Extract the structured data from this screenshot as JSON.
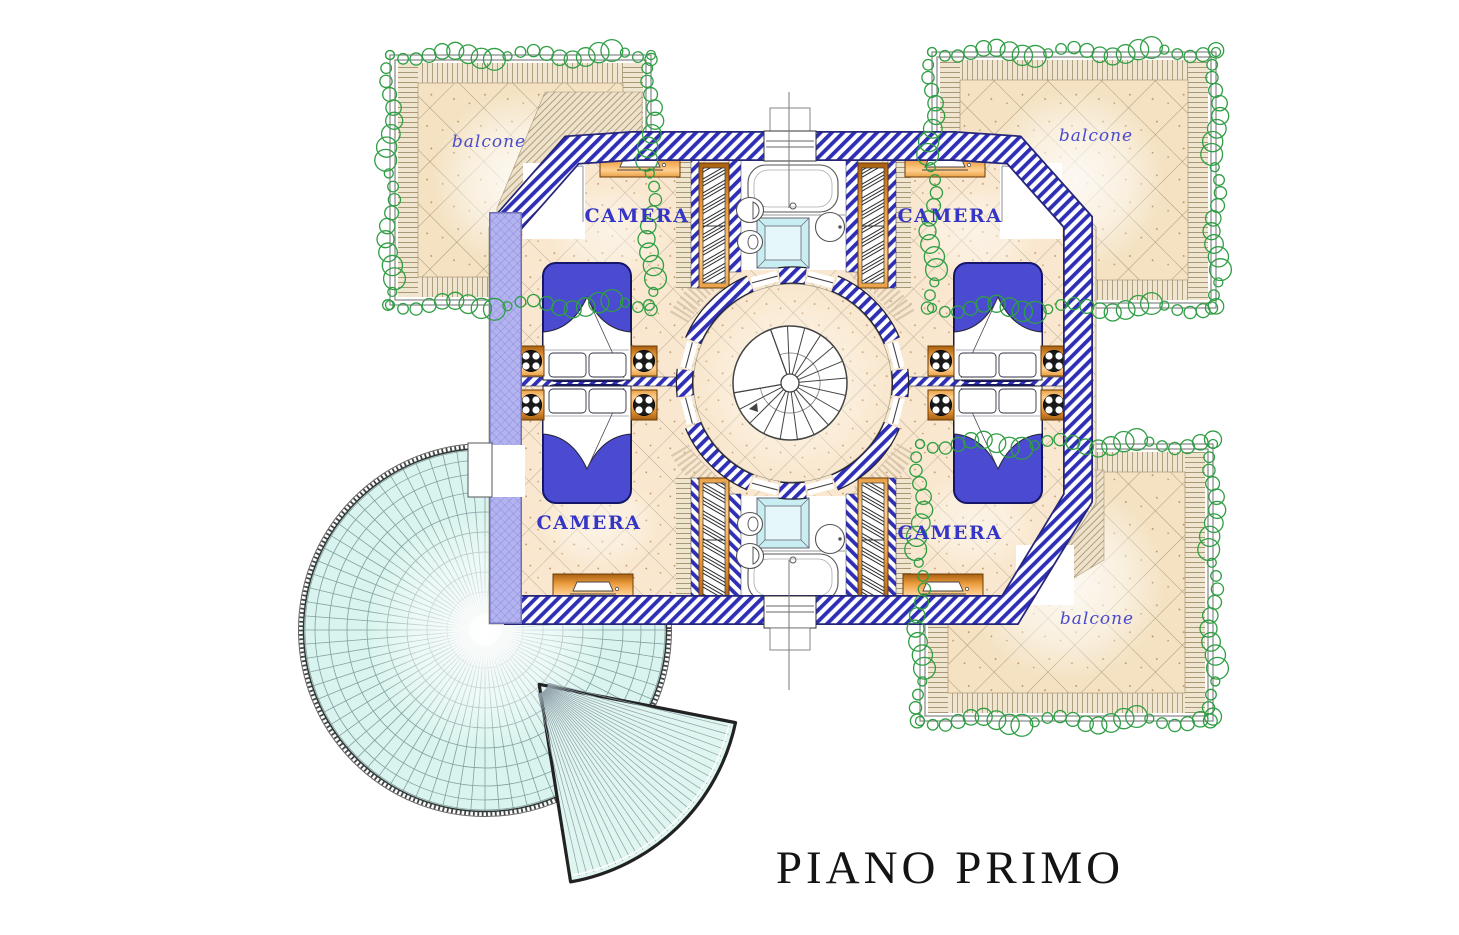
{
  "plan": {
    "title": "PIANO PRIMO",
    "rooms": [
      {
        "id": "camera-top-left",
        "label": "CAMERA"
      },
      {
        "id": "camera-top-right",
        "label": "CAMERA"
      },
      {
        "id": "camera-bottom-left",
        "label": "CAMERA"
      },
      {
        "id": "camera-bottom-right",
        "label": "CAMERA"
      }
    ],
    "balconies": [
      {
        "id": "balcone-top-left",
        "label": "balcone"
      },
      {
        "id": "balcone-top-right",
        "label": "balcone"
      },
      {
        "id": "balcone-bottom-right",
        "label": "balcone"
      }
    ],
    "features": [
      "spiral-staircase",
      "glass-dome-skylight",
      "glass-fan-canopy",
      "bathtub",
      "shower",
      "toilet",
      "bidet",
      "sink",
      "double-bed",
      "nightstand-lamp",
      "wardrobe",
      "dresser",
      "vine-hedge"
    ],
    "colors": {
      "wall_hatch_blue": "#2e2eb6",
      "wall_crosshatch_lavender": "#b3b3ef",
      "floor_tile_tan": "#f9e8cf",
      "balcony_tile": "#f4e2c2",
      "deck_plank": "#f0e5cf",
      "glass_cyan": "#d9f4ee",
      "shower_cyan": "#c9eef2",
      "bed_blue": "#4b4bd2",
      "furniture_orange": "#eb9b3d",
      "vine_green": "#2f9e44",
      "label_blue": "#3535c6",
      "title_black": "#141414"
    }
  }
}
